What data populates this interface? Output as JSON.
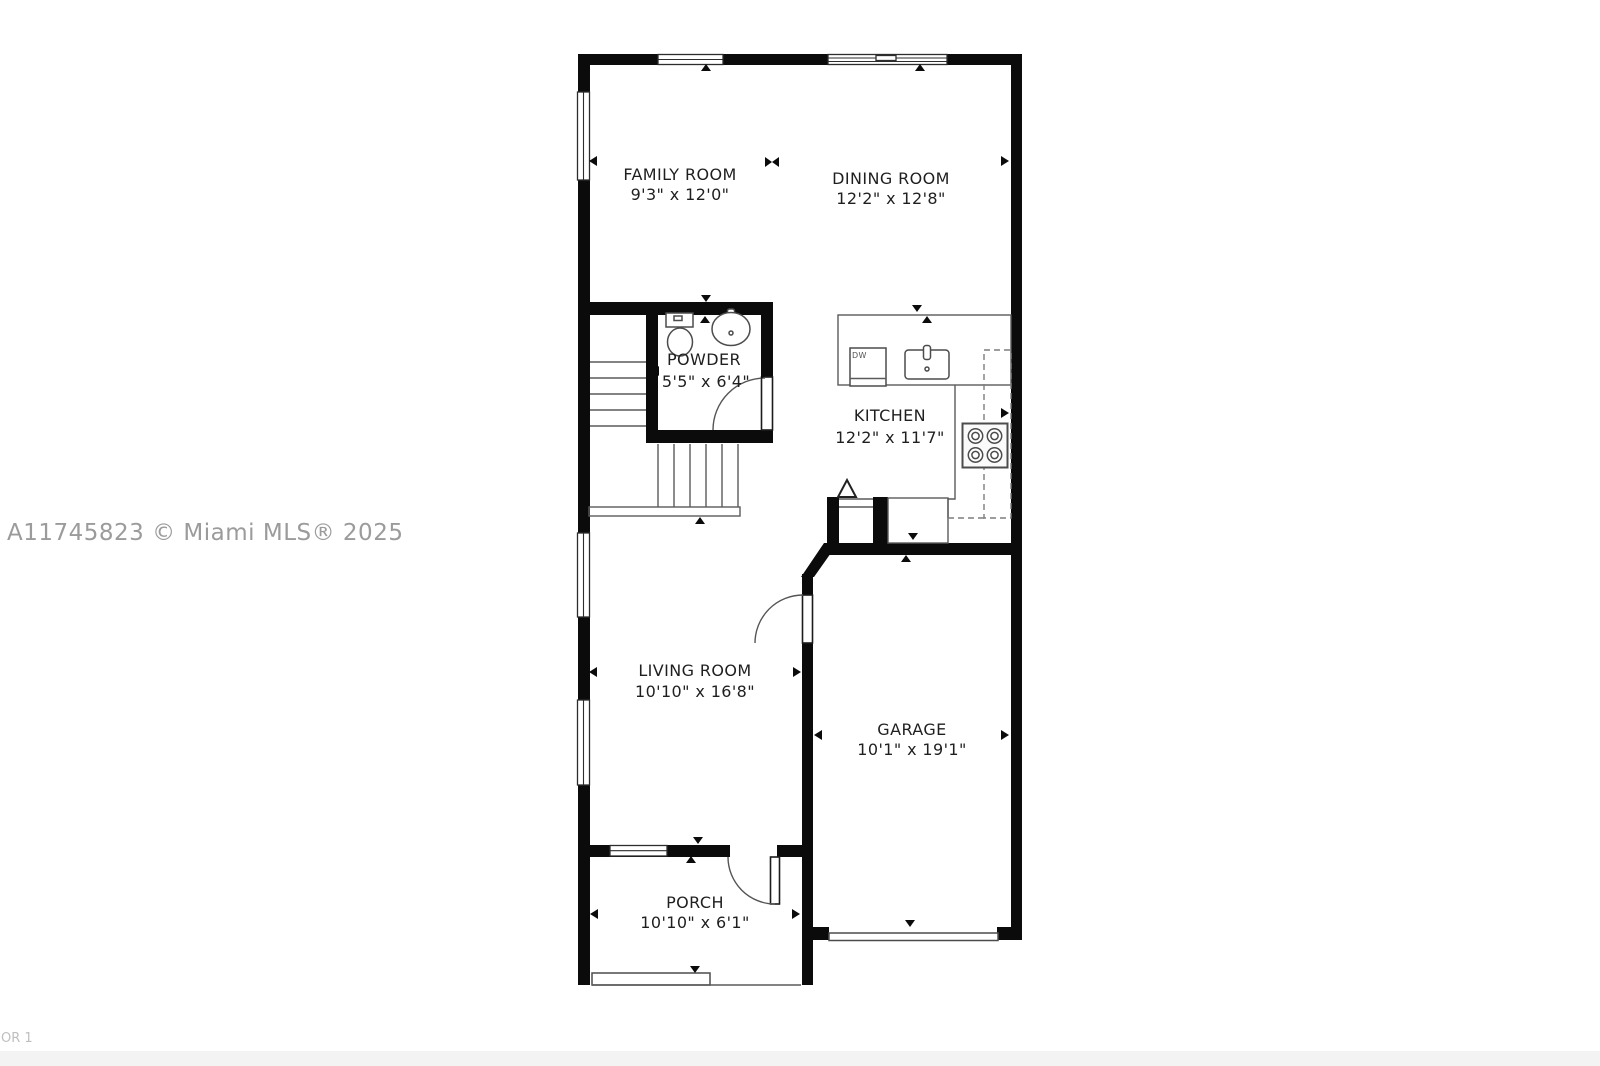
{
  "watermark": {
    "text": "A11745823 © Miami MLS® 2025"
  },
  "page_label": {
    "text": "OR 1"
  },
  "rooms": {
    "family": {
      "name": "FAMILY ROOM",
      "dims": "9'3\" x 12'0\""
    },
    "dining": {
      "name": "DINING ROOM",
      "dims": "12'2\" x 12'8\""
    },
    "powder": {
      "name": "POWDER",
      "dims": "5'5\" x 6'4\""
    },
    "kitchen": {
      "name": "KITCHEN",
      "dims": "12'2\" x 11'7\""
    },
    "living": {
      "name": "LIVING ROOM",
      "dims": "10'10\" x 16'8\""
    },
    "garage": {
      "name": "GARAGE",
      "dims": "10'1\" x 19'1\""
    },
    "porch": {
      "name": "PORCH",
      "dims": "10'10\" x 6'1\""
    }
  },
  "appliances": {
    "dishwasher": "DW"
  },
  "colors": {
    "wall": "#0b0b0b",
    "fixture_line": "#555555",
    "watermark": "#9b9b9b",
    "background": "#ffffff"
  }
}
